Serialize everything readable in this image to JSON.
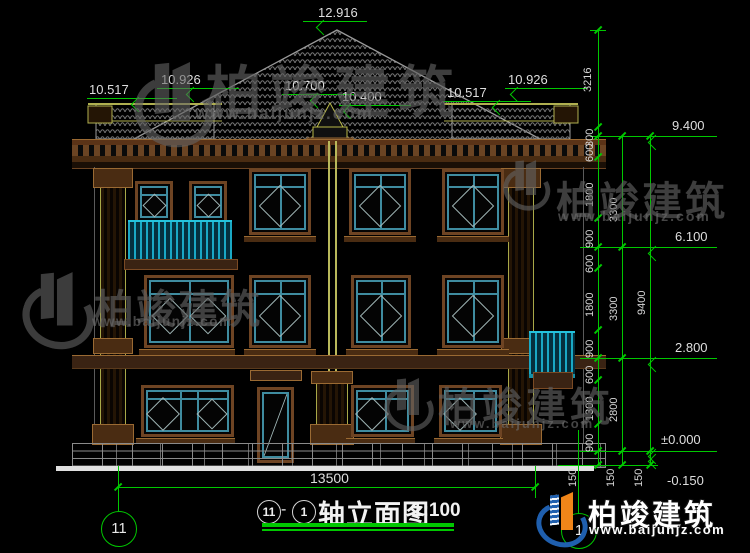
{
  "dims": {
    "top_levels": [
      "12.916",
      "10.517",
      "10.926",
      "10.700",
      "10.400",
      "10.517",
      "10.926"
    ],
    "right_levels": [
      "9.400",
      "6.100",
      "2.800",
      "±0.000",
      "-0.150"
    ],
    "chain_a": [
      "3216",
      "300",
      "600",
      "1800",
      "900",
      "600",
      "1800",
      "900",
      "600",
      "1300",
      "900",
      "150"
    ],
    "chain_b": [
      "3300",
      "3300",
      "2800",
      "150"
    ],
    "chain_c": [
      "9400",
      "150"
    ],
    "overall_width": "13500"
  },
  "axis": {
    "left": "11",
    "right": "1"
  },
  "title": {
    "axis_from": "11",
    "separator": "-",
    "axis_to": "1",
    "name": "轴立面图",
    "scale": "1:100"
  },
  "watermark": {
    "brand": "柏竣建筑",
    "url": "www.baijunjz.com"
  },
  "logo": {
    "brand": "柏竣建筑",
    "url": "www.baijunjz.com"
  },
  "colors": {
    "dim_green": "#00c800",
    "frame_brown": "#6e4423",
    "window_teal": "#3f8ca0",
    "railing_cyan": "#22b4cc",
    "pilaster_olive": "#a8a848",
    "logo_blue": "#1f5fae",
    "logo_orange": "#f08519"
  }
}
